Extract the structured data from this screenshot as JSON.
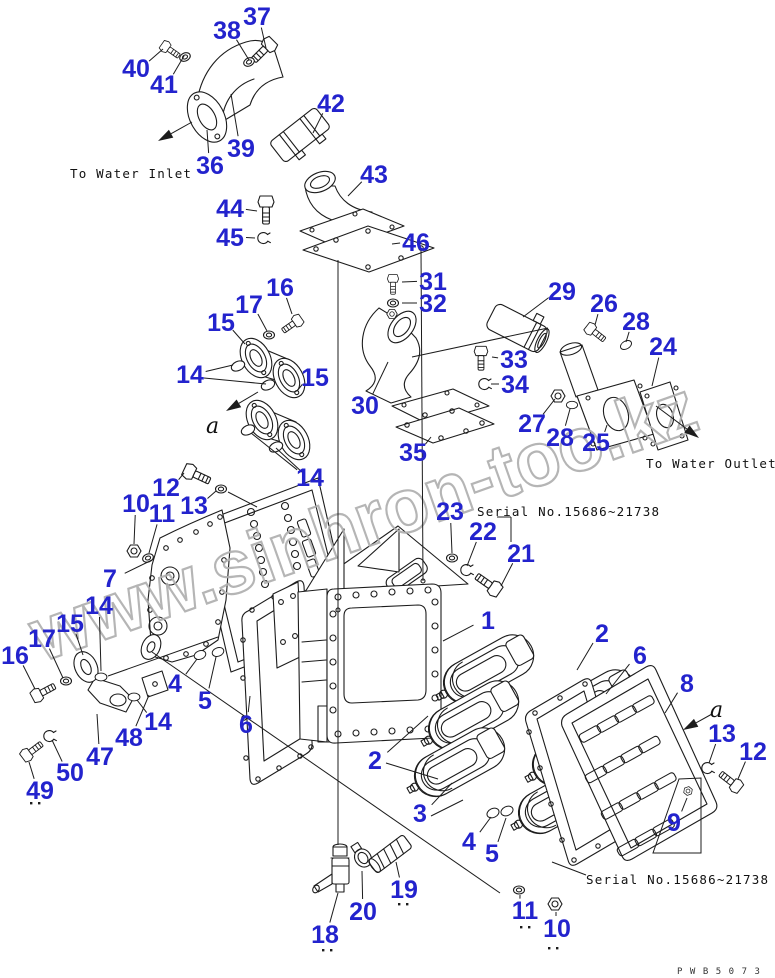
{
  "diagram": {
    "type": "exploded-parts-diagram",
    "watermark": "www.sinhron-too.kz",
    "annotations": [
      {
        "id": "to-water-inlet",
        "text": "To Water Inlet",
        "x": 70,
        "y": 178,
        "cls": "ann"
      },
      {
        "id": "to-water-outlet",
        "text": "To Water Outlet",
        "x": 646,
        "y": 468,
        "cls": "ann"
      },
      {
        "id": "serial-top",
        "text": "Serial No.15686~21738",
        "x": 477,
        "y": 516,
        "cls": "ann"
      },
      {
        "id": "serial-bottom",
        "text": "Serial No.15686~21738",
        "x": 586,
        "y": 884,
        "cls": "ann"
      },
      {
        "id": "drawing-code",
        "text": "PWB5073",
        "x": 677,
        "y": 974,
        "cls": "code"
      },
      {
        "id": "view-a-1",
        "text": "a",
        "x": 206,
        "y": 433,
        "cls": "viewmark"
      },
      {
        "id": "view-a-2",
        "text": "a",
        "x": 710,
        "y": 717,
        "cls": "viewmark"
      }
    ],
    "callouts": [
      {
        "n": "37",
        "x": 257,
        "y": 16,
        "tx": 266,
        "ty": 48
      },
      {
        "n": "38",
        "x": 227,
        "y": 30,
        "tx": 249,
        "ty": 60
      },
      {
        "n": "40",
        "x": 136,
        "y": 68,
        "tx": 163,
        "ty": 49
      },
      {
        "n": "41",
        "x": 164,
        "y": 84,
        "tx": 184,
        "ty": 56
      },
      {
        "n": "42",
        "x": 331,
        "y": 103,
        "tx": 313,
        "ty": 133
      },
      {
        "n": "39",
        "x": 241,
        "y": 148,
        "tx": 231,
        "ty": 94
      },
      {
        "n": "36",
        "x": 210,
        "y": 165,
        "tx": 207,
        "ty": 130
      },
      {
        "n": "43",
        "x": 374,
        "y": 174,
        "tx": 348,
        "ty": 196
      },
      {
        "n": "44",
        "x": 230,
        "y": 208,
        "tx": 257,
        "ty": 211
      },
      {
        "n": "45",
        "x": 230,
        "y": 237,
        "tx": 255,
        "ty": 238
      },
      {
        "n": "46",
        "x": 416,
        "y": 242,
        "tx": 392,
        "ty": 244
      },
      {
        "n": "31",
        "x": 433,
        "y": 281,
        "tx": 402,
        "ty": 282
      },
      {
        "n": "32",
        "x": 433,
        "y": 303,
        "tx": 402,
        "ty": 303
      },
      {
        "n": "16",
        "x": 280,
        "y": 287,
        "tx": 292,
        "ty": 314
      },
      {
        "n": "17",
        "x": 249,
        "y": 304,
        "tx": 267,
        "ty": 331
      },
      {
        "n": "15",
        "x": 221,
        "y": 322,
        "tx": 245,
        "ty": 344
      },
      {
        "n": "14",
        "x": 190,
        "y": 374,
        "tx": 233,
        "ty": 365
      },
      {
        "n": "15",
        "x": 315,
        "y": 377,
        "tx": 297,
        "ty": 391
      },
      {
        "n": "30",
        "x": 365,
        "y": 405,
        "tx": 388,
        "ty": 362
      },
      {
        "n": "14",
        "x": 310,
        "y": 477,
        "tx": 251,
        "ty": 433
      },
      {
        "n": "35",
        "x": 413,
        "y": 452,
        "tx": 431,
        "ty": 437
      },
      {
        "n": "29",
        "x": 562,
        "y": 291,
        "tx": 523,
        "ty": 317
      },
      {
        "n": "26",
        "x": 604,
        "y": 303,
        "tx": 595,
        "ty": 325
      },
      {
        "n": "28",
        "x": 636,
        "y": 321,
        "tx": 626,
        "ty": 342
      },
      {
        "n": "24",
        "x": 663,
        "y": 346,
        "tx": 652,
        "ty": 386
      },
      {
        "n": "33",
        "x": 514,
        "y": 359,
        "tx": 492,
        "ty": 357
      },
      {
        "n": "34",
        "x": 515,
        "y": 384,
        "tx": 491,
        "ty": 384
      },
      {
        "n": "27",
        "x": 532,
        "y": 423,
        "tx": 555,
        "ty": 399
      },
      {
        "n": "28",
        "x": 560,
        "y": 437,
        "tx": 570,
        "ty": 409
      },
      {
        "n": "25",
        "x": 596,
        "y": 442,
        "tx": 607,
        "ty": 425
      },
      {
        "n": "23",
        "x": 450,
        "y": 511,
        "tx": 452,
        "ty": 553
      },
      {
        "n": "22",
        "x": 483,
        "y": 531,
        "tx": 467,
        "ty": 566
      },
      {
        "n": "21",
        "x": 521,
        "y": 553,
        "tx": 501,
        "ty": 586
      },
      {
        "n": "10",
        "x": 136,
        "y": 503,
        "tx": 134,
        "ty": 544
      },
      {
        "n": "12",
        "x": 166,
        "y": 487,
        "tx": 184,
        "ty": 473
      },
      {
        "n": "11",
        "x": 162,
        "y": 513,
        "tx": 149,
        "ty": 553
      },
      {
        "n": "13",
        "x": 194,
        "y": 505,
        "tx": 216,
        "ty": 491
      },
      {
        "n": "7",
        "x": 110,
        "y": 578,
        "tx": 152,
        "ty": 560
      },
      {
        "n": "14",
        "x": 99,
        "y": 605,
        "tx": 101,
        "ty": 671
      },
      {
        "n": "15",
        "x": 70,
        "y": 623,
        "tx": 83,
        "ty": 655
      },
      {
        "n": "17",
        "x": 42,
        "y": 638,
        "tx": 63,
        "ty": 678
      },
      {
        "n": "16",
        "x": 15,
        "y": 655,
        "tx": 35,
        "ty": 689
      },
      {
        "n": "4",
        "x": 175,
        "y": 683,
        "tx": 197,
        "ty": 659
      },
      {
        "n": "5",
        "x": 205,
        "y": 700,
        "tx": 216,
        "ty": 657
      },
      {
        "n": "14",
        "x": 158,
        "y": 721,
        "tx": 137,
        "ty": 700
      },
      {
        "n": "48",
        "x": 129,
        "y": 737,
        "tx": 149,
        "ty": 695
      },
      {
        "n": "47",
        "x": 100,
        "y": 756,
        "tx": 97,
        "ty": 714
      },
      {
        "n": "50",
        "x": 70,
        "y": 772,
        "tx": 52,
        "ty": 740
      },
      {
        "n": "49",
        "x": 40,
        "y": 790,
        "tx": 29,
        "ty": 762
      },
      {
        "n": "1",
        "x": 488,
        "y": 620,
        "tx": 443,
        "ty": 641
      },
      {
        "n": "6",
        "x": 246,
        "y": 724,
        "tx": 250,
        "ty": 696
      },
      {
        "n": "2",
        "x": 602,
        "y": 633,
        "tx": 577,
        "ty": 670
      },
      {
        "n": "6",
        "x": 640,
        "y": 655,
        "tx": 606,
        "ty": 694
      },
      {
        "n": "8",
        "x": 687,
        "y": 683,
        "tx": 665,
        "ty": 713
      },
      {
        "n": "13",
        "x": 722,
        "y": 733,
        "tx": 709,
        "ty": 763
      },
      {
        "n": "12",
        "x": 753,
        "y": 751,
        "tx": 738,
        "ty": 779
      },
      {
        "n": "2",
        "x": 375,
        "y": 760,
        "tx": 428,
        "ty": 716
      },
      {
        "n": "3",
        "x": 420,
        "y": 813,
        "tx": 452,
        "ty": 783
      },
      {
        "n": "4",
        "x": 469,
        "y": 841,
        "tx": 491,
        "ty": 817
      },
      {
        "n": "5",
        "x": 492,
        "y": 853,
        "tx": 506,
        "ty": 818
      },
      {
        "n": "9",
        "x": 674,
        "y": 822,
        "tx": 687,
        "ty": 798
      },
      {
        "n": "11",
        "x": 525,
        "y": 910,
        "tx": 520,
        "ty": 895
      },
      {
        "n": "10",
        "x": 557,
        "y": 928,
        "tx": 556,
        "ty": 912
      },
      {
        "n": "18",
        "x": 325,
        "y": 934,
        "tx": 338,
        "ty": 893
      },
      {
        "n": "20",
        "x": 363,
        "y": 911,
        "tx": 362,
        "ty": 871
      },
      {
        "n": "19",
        "x": 404,
        "y": 889,
        "tx": 396,
        "ty": 862
      }
    ],
    "extra_leaders": [
      [
        204,
        378,
        266,
        384
      ],
      [
        303,
        473,
        276,
        448
      ],
      [
        386,
        763,
        438,
        779
      ],
      [
        431,
        816,
        463,
        800
      ],
      [
        108,
        676,
        218,
        637
      ],
      [
        152,
        652,
        500,
        893
      ],
      [
        552,
        862,
        586,
        875
      ],
      [
        338,
        260,
        338,
        845
      ],
      [
        421,
        250,
        423,
        581
      ],
      [
        412,
        357,
        548,
        328
      ],
      [
        497,
        517,
        511,
        517
      ],
      [
        511,
        517,
        511,
        542
      ],
      [
        228,
        492,
        257,
        507
      ]
    ],
    "bracket_9": [
      [
        679,
        779
      ],
      [
        701,
        778
      ],
      [
        701,
        853
      ],
      [
        653,
        853
      ]
    ],
    "arrows": [
      {
        "id": "inlet-direction-arrow",
        "x1": 192,
        "y1": 122,
        "x2": 158,
        "y2": 141
      },
      {
        "id": "outlet-direction-arrow",
        "x1": 656,
        "y1": 406,
        "x2": 699,
        "y2": 438
      },
      {
        "id": "view-a-arrow-1",
        "x1": 258,
        "y1": 392,
        "x2": 226,
        "y2": 411
      },
      {
        "id": "view-a-arrow-2",
        "x1": 712,
        "y1": 714,
        "x2": 683,
        "y2": 730
      }
    ],
    "ref_dots": [
      [
        30,
        802
      ],
      [
        38,
        802
      ],
      [
        322,
        949
      ],
      [
        330,
        949
      ],
      [
        398,
        903
      ],
      [
        406,
        903
      ],
      [
        520,
        926
      ],
      [
        528,
        926
      ],
      [
        548,
        947
      ],
      [
        556,
        947
      ]
    ]
  },
  "colors": {
    "background": "#ffffff",
    "line": "#1c1c1c",
    "callout": "#2323cd",
    "watermark": "#afafaf"
  }
}
